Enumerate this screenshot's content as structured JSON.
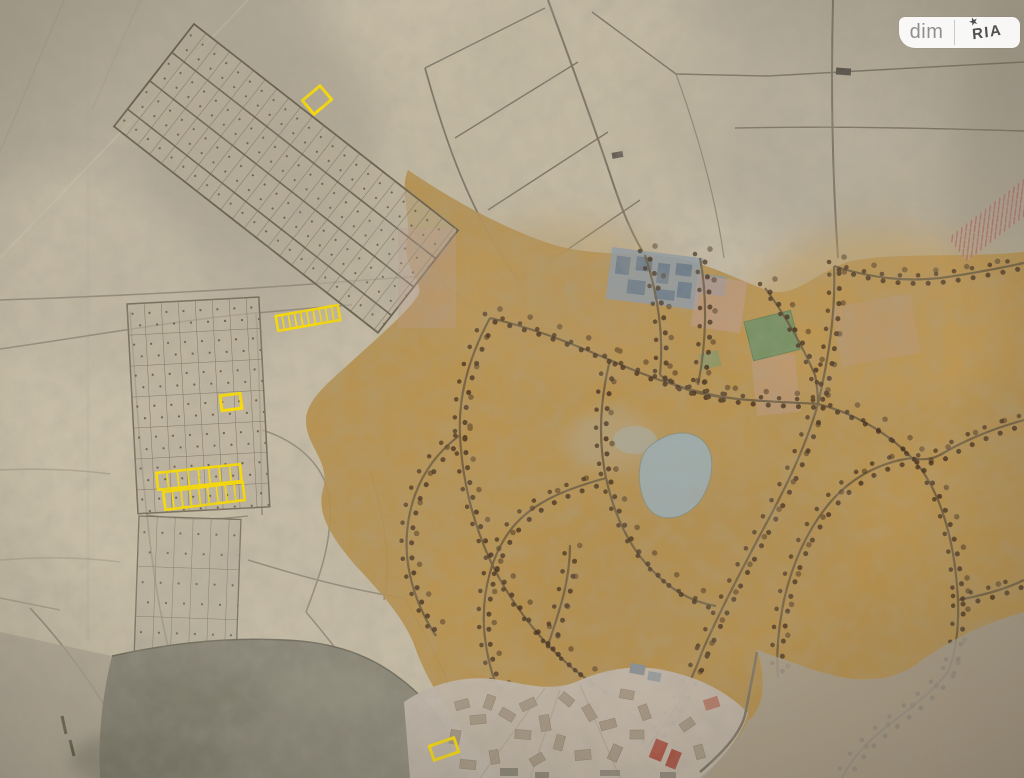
{
  "watermark": {
    "left_label": "dim",
    "right_label": "RIA",
    "star": "★"
  },
  "palette": {
    "paper_beige": "#c6bca6",
    "built_up_ochre": "#b58f4c",
    "road_dark": "#6e5d41",
    "tree_dot": "#46311f",
    "lake_gray": "#8a8778",
    "pond_blue": "#9dafb4",
    "green_area": "#6f9168",
    "red_building": "#ad5848",
    "highlight_yellow": "#ffdf00",
    "watermark_bg": "#ffffff",
    "watermark_dim_text": "#8f8f8f",
    "watermark_ria_text": "#4f4f4f"
  },
  "map": {
    "kind": "photographed paper master plan with highlighted land plots",
    "highlights": {
      "color": "#ffdf00",
      "plots": [
        {
          "id": "a",
          "cx": 317,
          "cy": 100,
          "w": 23,
          "h": 18,
          "rot": -40,
          "cols": 1,
          "stroke": 3
        },
        {
          "id": "b",
          "cx": 308,
          "cy": 318,
          "w": 63,
          "h": 15,
          "rot": -10,
          "cols": 10,
          "stroke": 2.6
        },
        {
          "id": "c",
          "cx": 231,
          "cy": 402,
          "w": 20,
          "h": 15,
          "rot": -7,
          "cols": 1,
          "stroke": 3
        },
        {
          "id": "d1",
          "cx": 199,
          "cy": 477,
          "w": 84,
          "h": 17,
          "rot": -6,
          "cols": 8,
          "stroke": 2.6
        },
        {
          "id": "d2",
          "cx": 204,
          "cy": 496,
          "w": 80,
          "h": 18,
          "rot": -7,
          "cols": 9,
          "stroke": 2.6
        },
        {
          "id": "e",
          "cx": 444,
          "cy": 749,
          "w": 26,
          "h": 15,
          "rot": -19,
          "cols": 1,
          "stroke": 3
        }
      ]
    }
  }
}
